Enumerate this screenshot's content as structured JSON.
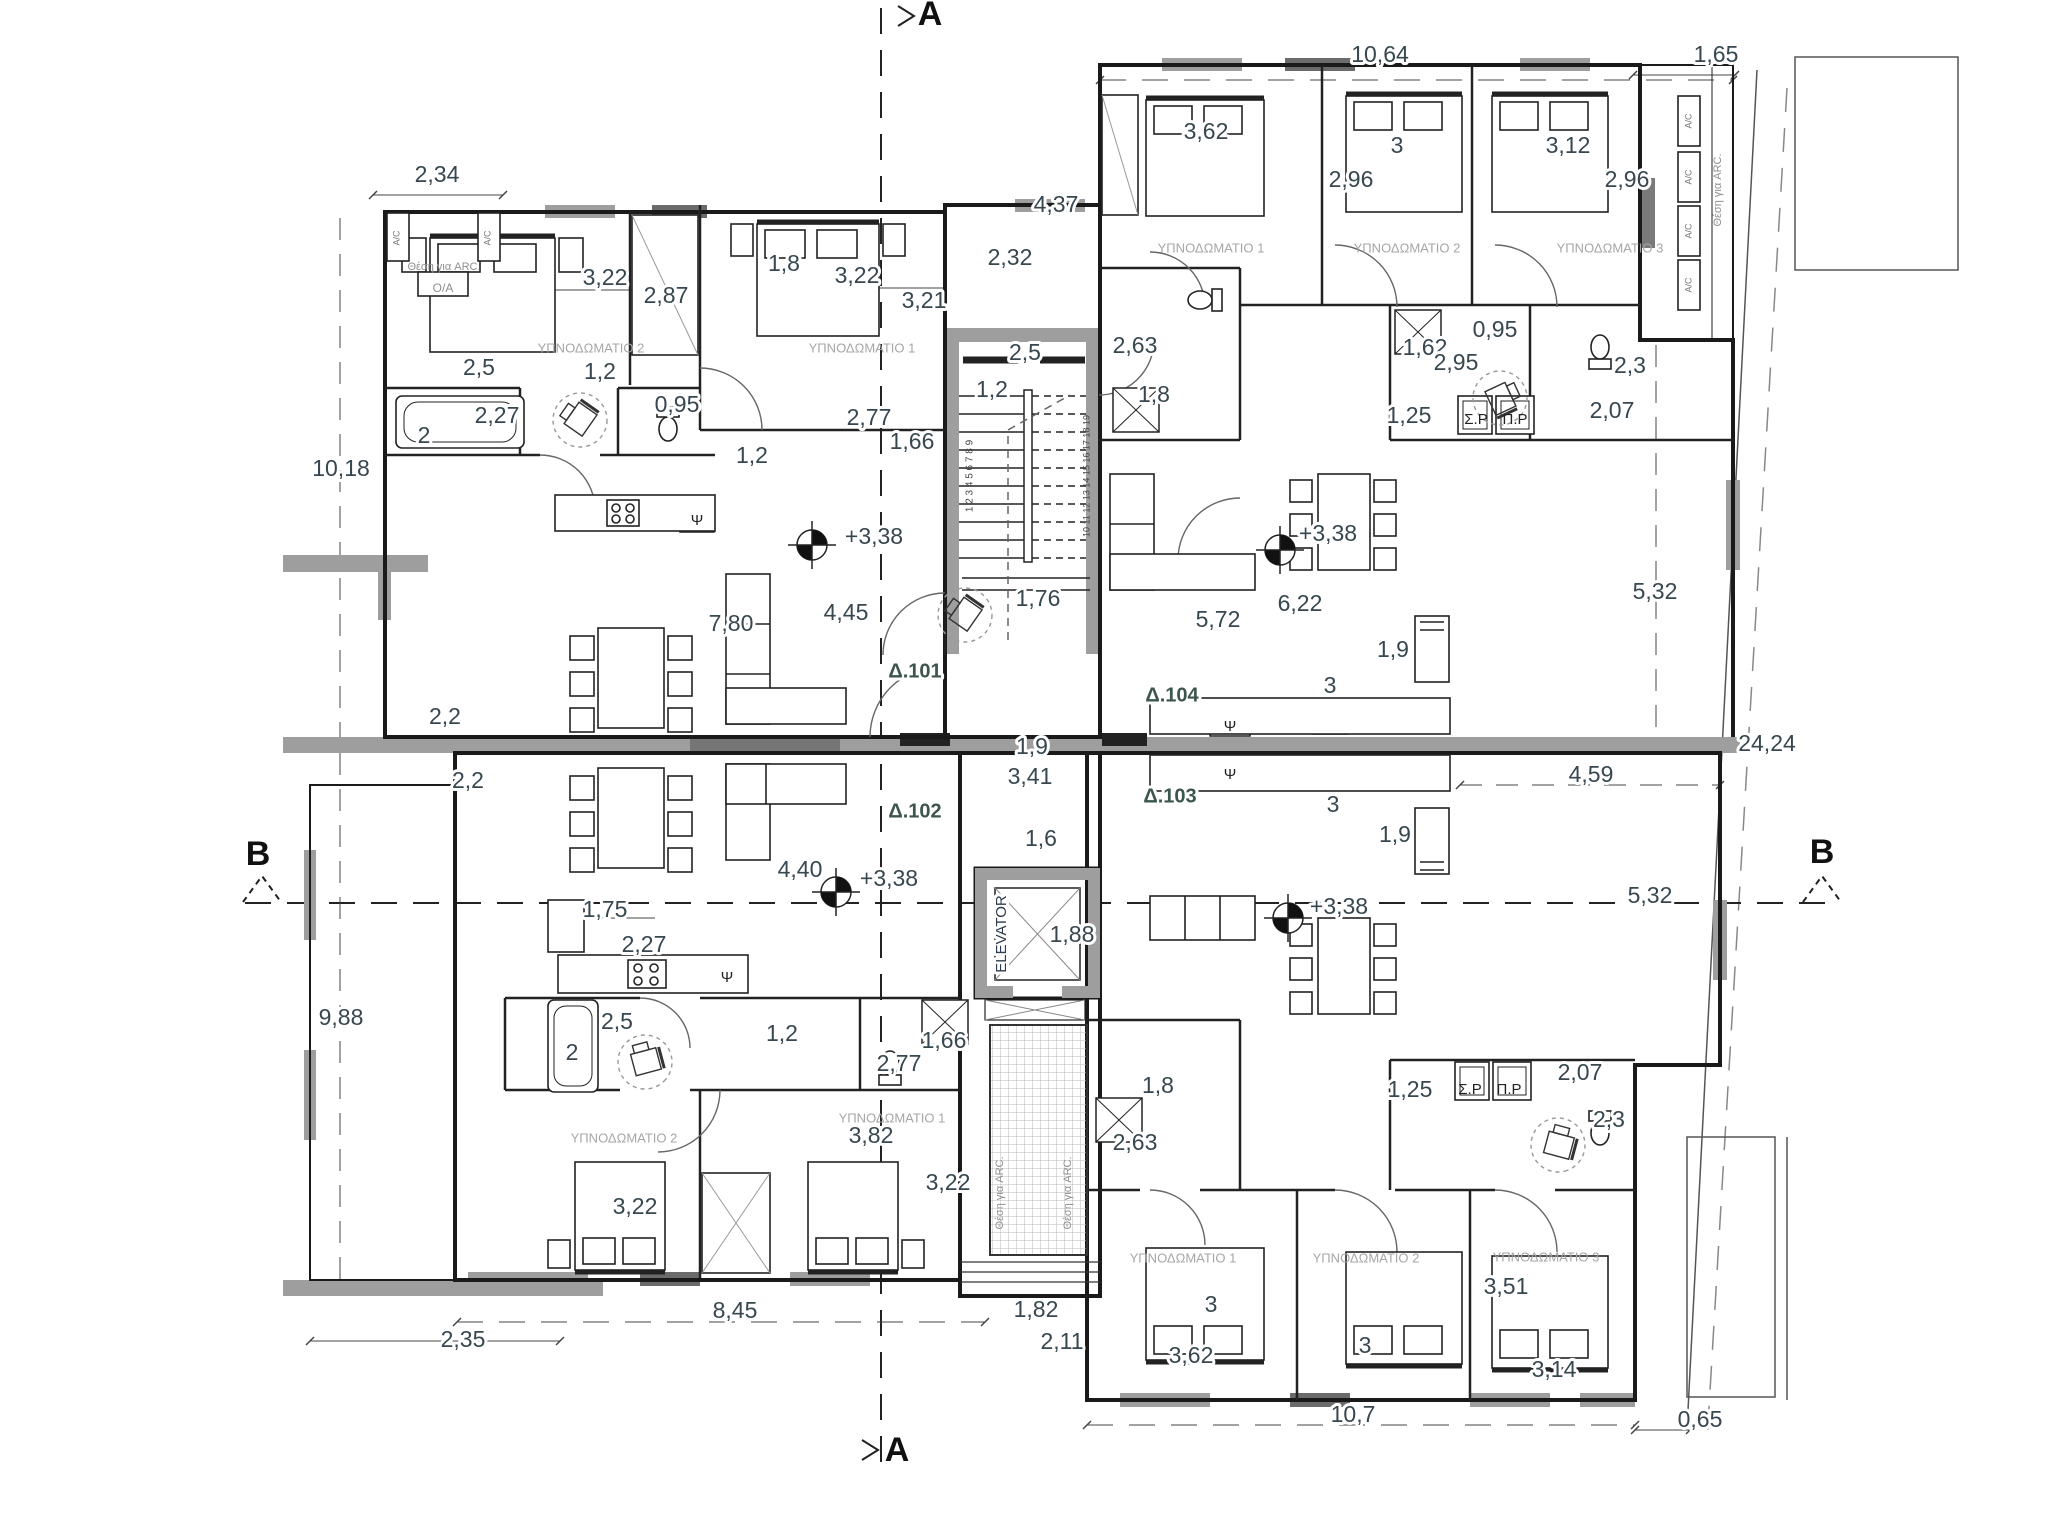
{
  "title": "Floor plan level +3,38 — apartments Δ.101, Δ.102, Δ.103, Δ.104",
  "colors": {
    "dim": "#37474f",
    "room": "#a6a6a6",
    "apt": "#3c554d",
    "sec": "#111111",
    "arc": "#8f8f8f",
    "ac": "#777777",
    "elev": "#2e3b4e",
    "psi": "#222222",
    "num": "#444444",
    "wall": "#1a1a1a",
    "gray_wall": "#9e9e9e"
  },
  "labels": [
    {
      "t": "A",
      "x": 930,
      "y": 16,
      "s": 34,
      "k": "sec",
      "n": "section-marker-a-top"
    },
    {
      "t": "A",
      "x": 897,
      "y": 1452,
      "s": 34,
      "k": "sec",
      "n": "section-marker-a-bottom"
    },
    {
      "t": "B",
      "x": 258,
      "y": 856,
      "s": 34,
      "k": "sec",
      "n": "section-marker-b-left"
    },
    {
      "t": "B",
      "x": 1822,
      "y": 854,
      "s": 34,
      "k": "sec",
      "n": "section-marker-b-right"
    },
    {
      "t": "2,34",
      "x": 437,
      "y": 176
    },
    {
      "t": "10,64",
      "x": 1380,
      "y": 56
    },
    {
      "t": "1,65",
      "x": 1716,
      "y": 56
    },
    {
      "t": "4,37",
      "x": 1056,
      "y": 206
    },
    {
      "t": "2,32",
      "x": 1010,
      "y": 259
    },
    {
      "t": "3,22",
      "x": 605,
      "y": 279
    },
    {
      "t": "2,87",
      "x": 666,
      "y": 297
    },
    {
      "t": "1,8",
      "x": 784,
      "y": 265
    },
    {
      "t": "3,22",
      "x": 857,
      "y": 277
    },
    {
      "t": "3,21",
      "x": 924,
      "y": 302
    },
    {
      "t": "0,95",
      "x": 677,
      "y": 406
    },
    {
      "t": "2,5",
      "x": 479,
      "y": 369
    },
    {
      "t": "2",
      "x": 424,
      "y": 437
    },
    {
      "t": "2,27",
      "x": 497,
      "y": 417
    },
    {
      "t": "1,2",
      "x": 600,
      "y": 373
    },
    {
      "t": "2,77",
      "x": 869,
      "y": 419
    },
    {
      "t": "1,66",
      "x": 912,
      "y": 443
    },
    {
      "t": "1,2",
      "x": 752,
      "y": 457
    },
    {
      "t": "2,5",
      "x": 1025,
      "y": 354
    },
    {
      "t": "1,2",
      "x": 992,
      "y": 391
    },
    {
      "t": "3,62",
      "x": 1206,
      "y": 133
    },
    {
      "t": "3",
      "x": 1397,
      "y": 147
    },
    {
      "t": "2,96",
      "x": 1351,
      "y": 181
    },
    {
      "t": "3,12",
      "x": 1568,
      "y": 147
    },
    {
      "t": "2,96",
      "x": 1627,
      "y": 181
    },
    {
      "t": "2,63",
      "x": 1135,
      "y": 347
    },
    {
      "t": "1,8",
      "x": 1154,
      "y": 396
    },
    {
      "t": "0,95",
      "x": 1495,
      "y": 331
    },
    {
      "t": "1,62",
      "x": 1425,
      "y": 349
    },
    {
      "t": "2,95",
      "x": 1456,
      "y": 364
    },
    {
      "t": "1,25",
      "x": 1409,
      "y": 417
    },
    {
      "t": "Σ.Ρ",
      "x": 1476,
      "y": 420,
      "s": 15,
      "k": "psi",
      "n": "washer-label"
    },
    {
      "t": "Π.Ρ",
      "x": 1515,
      "y": 420,
      "s": 15,
      "k": "psi",
      "n": "dryer-label"
    },
    {
      "t": "2,3",
      "x": 1630,
      "y": 367
    },
    {
      "t": "2,07",
      "x": 1612,
      "y": 412
    },
    {
      "t": "10,18",
      "x": 341,
      "y": 470
    },
    {
      "t": "2,2",
      "x": 445,
      "y": 718
    },
    {
      "t": "2,2",
      "x": 468,
      "y": 782
    },
    {
      "t": "9,88",
      "x": 341,
      "y": 1019
    },
    {
      "t": "7,80",
      "x": 731,
      "y": 625
    },
    {
      "t": "4,45",
      "x": 846,
      "y": 614
    },
    {
      "t": "+3,38",
      "x": 874,
      "y": 538
    },
    {
      "t": "+3,38",
      "x": 1328,
      "y": 535
    },
    {
      "t": "5,72",
      "x": 1218,
      "y": 621
    },
    {
      "t": "6,22",
      "x": 1300,
      "y": 605
    },
    {
      "t": "1,9",
      "x": 1393,
      "y": 651
    },
    {
      "t": "3",
      "x": 1330,
      "y": 687
    },
    {
      "t": "1,76",
      "x": 1038,
      "y": 600
    },
    {
      "t": "Δ.101",
      "x": 915,
      "y": 672,
      "s": 20,
      "k": "apt",
      "n": "apartment-label-101"
    },
    {
      "t": "Δ.104",
      "x": 1172,
      "y": 696,
      "s": 20,
      "k": "apt",
      "n": "apartment-label-104"
    },
    {
      "t": "Δ.102",
      "x": 915,
      "y": 812,
      "s": 20,
      "k": "apt",
      "n": "apartment-label-102"
    },
    {
      "t": "Δ.103",
      "x": 1170,
      "y": 797,
      "s": 20,
      "k": "apt",
      "n": "apartment-label-103"
    },
    {
      "t": "1,9",
      "x": 1032,
      "y": 748
    },
    {
      "t": "3,41",
      "x": 1030,
      "y": 778
    },
    {
      "t": "1,6",
      "x": 1041,
      "y": 840
    },
    {
      "t": "3",
      "x": 1333,
      "y": 806
    },
    {
      "t": "1,9",
      "x": 1395,
      "y": 836
    },
    {
      "t": "4,59",
      "x": 1591,
      "y": 776
    },
    {
      "t": "24,24",
      "x": 1767,
      "y": 745
    },
    {
      "t": "5,32",
      "x": 1655,
      "y": 593
    },
    {
      "t": "5,32",
      "x": 1650,
      "y": 897
    },
    {
      "t": "ELEVATOR",
      "x": 1002,
      "y": 934,
      "s": 15,
      "r": -90,
      "k": "elev",
      "n": "elevator-label"
    },
    {
      "t": "1,88",
      "x": 1072,
      "y": 936
    },
    {
      "t": "+3,38",
      "x": 889,
      "y": 880
    },
    {
      "t": "4,40",
      "x": 800,
      "y": 871
    },
    {
      "t": "+3,38",
      "x": 1339,
      "y": 908
    },
    {
      "t": "1,75",
      "x": 605,
      "y": 911
    },
    {
      "t": "2,27",
      "x": 644,
      "y": 946
    },
    {
      "t": "2,5",
      "x": 617,
      "y": 1023
    },
    {
      "t": "2",
      "x": 572,
      "y": 1054
    },
    {
      "t": "1,2",
      "x": 782,
      "y": 1035
    },
    {
      "t": "2,77",
      "x": 899,
      "y": 1065
    },
    {
      "t": "1,66",
      "x": 944,
      "y": 1042
    },
    {
      "t": "3,82",
      "x": 871,
      "y": 1137
    },
    {
      "t": "3,22",
      "x": 635,
      "y": 1208
    },
    {
      "t": "3,22",
      "x": 948,
      "y": 1184
    },
    {
      "t": "1,8",
      "x": 1158,
      "y": 1087
    },
    {
      "t": "2,63",
      "x": 1135,
      "y": 1144
    },
    {
      "t": "1,25",
      "x": 1410,
      "y": 1091
    },
    {
      "t": "Σ.Ρ",
      "x": 1470,
      "y": 1090,
      "s": 15,
      "k": "psi",
      "n": "washer-label"
    },
    {
      "t": "Π.Ρ",
      "x": 1509,
      "y": 1090,
      "s": 15,
      "k": "psi",
      "n": "dryer-label"
    },
    {
      "t": "2,07",
      "x": 1580,
      "y": 1074
    },
    {
      "t": "2,3",
      "x": 1609,
      "y": 1121
    },
    {
      "t": "3",
      "x": 1211,
      "y": 1306
    },
    {
      "t": "3,62",
      "x": 1191,
      "y": 1357
    },
    {
      "t": "3",
      "x": 1365,
      "y": 1347
    },
    {
      "t": "3,51",
      "x": 1506,
      "y": 1288
    },
    {
      "t": "3,14",
      "x": 1554,
      "y": 1371
    },
    {
      "t": "8,45",
      "x": 735,
      "y": 1312
    },
    {
      "t": "2,35",
      "x": 463,
      "y": 1341
    },
    {
      "t": "1,82",
      "x": 1036,
      "y": 1311
    },
    {
      "t": "2,11",
      "x": 1062,
      "y": 1343
    },
    {
      "t": "10,7",
      "x": 1353,
      "y": 1416
    },
    {
      "t": "0,65",
      "x": 1700,
      "y": 1421
    },
    {
      "t": "ΥΠΝΟΔΩΜΑΤΙΟ 2",
      "x": 591,
      "y": 349,
      "s": 13,
      "k": "room",
      "n": "room-label-bedroom2"
    },
    {
      "t": "ΥΠΝΟΔΩΜΑΤΙΟ 1",
      "x": 862,
      "y": 349,
      "s": 13,
      "k": "room",
      "n": "room-label-bedroom1"
    },
    {
      "t": "ΥΠΝΟΔΩΜΑΤΙΟ 1",
      "x": 1211,
      "y": 249,
      "s": 13,
      "k": "room",
      "n": "room-label-bedroom1"
    },
    {
      "t": "ΥΠΝΟΔΩΜΑΤΙΟ 2",
      "x": 1407,
      "y": 249,
      "s": 13,
      "k": "room",
      "n": "room-label-bedroom2"
    },
    {
      "t": "ΥΠΝΟΔΩΜΑΤΙΟ 3",
      "x": 1610,
      "y": 249,
      "s": 13,
      "k": "room",
      "n": "room-label-bedroom3"
    },
    {
      "t": "ΥΠΝΟΔΩΜΑΤΙΟ 2",
      "x": 624,
      "y": 1139,
      "s": 13,
      "k": "room",
      "n": "room-label-bedroom2"
    },
    {
      "t": "ΥΠΝΟΔΩΜΑΤΙΟ 1",
      "x": 892,
      "y": 1119,
      "s": 13,
      "k": "room",
      "n": "room-label-bedroom1"
    },
    {
      "t": "ΥΠΝΟΔΩΜΑΤΙΟ 1",
      "x": 1183,
      "y": 1259,
      "s": 13,
      "k": "room",
      "n": "room-label-bedroom1"
    },
    {
      "t": "ΥΠΝΟΔΩΜΑΤΙΟ 2",
      "x": 1366,
      "y": 1259,
      "s": 13,
      "k": "room",
      "n": "room-label-bedroom2"
    },
    {
      "t": "ΥΠΝΟΔΩΜΑΤΙΟ 3",
      "x": 1546,
      "y": 1258,
      "s": 13,
      "k": "room",
      "n": "room-label-bedroom3"
    },
    {
      "t": "Θέση για ARC.",
      "x": 444,
      "y": 267,
      "s": 11,
      "k": "arc",
      "n": "arc-area-label"
    },
    {
      "t": "O/A",
      "x": 443,
      "y": 289,
      "s": 12,
      "k": "arc",
      "n": "oa-label"
    },
    {
      "t": "Θέση για ARC.",
      "x": 1718,
      "y": 190,
      "s": 11,
      "r": -90,
      "k": "arc",
      "n": "arc-area-label"
    },
    {
      "t": "Θέση για ARC.",
      "x": 1000,
      "y": 1193,
      "s": 11,
      "r": -90,
      "k": "arc",
      "n": "arc-area-label"
    },
    {
      "t": "Θέση για ARC.",
      "x": 1068,
      "y": 1193,
      "s": 11,
      "r": -90,
      "k": "arc",
      "n": "arc-area-label"
    },
    {
      "t": "A/C",
      "x": 397,
      "y": 238,
      "s": 9,
      "r": -90,
      "k": "ac",
      "n": "ac-unit-label"
    },
    {
      "t": "A/C",
      "x": 488,
      "y": 238,
      "s": 9,
      "r": -90,
      "k": "ac",
      "n": "ac-unit-label"
    },
    {
      "t": "A/C",
      "x": 1689,
      "y": 121,
      "s": 9,
      "r": -90,
      "k": "ac",
      "n": "ac-unit-label"
    },
    {
      "t": "A/C",
      "x": 1689,
      "y": 177,
      "s": 9,
      "r": -90,
      "k": "ac",
      "n": "ac-unit-label"
    },
    {
      "t": "A/C",
      "x": 1689,
      "y": 231,
      "s": 9,
      "r": -90,
      "k": "ac",
      "n": "ac-unit-label"
    },
    {
      "t": "A/C",
      "x": 1689,
      "y": 285,
      "s": 9,
      "r": -90,
      "k": "ac",
      "n": "ac-unit-label"
    },
    {
      "t": "Ψ",
      "x": 697,
      "y": 521,
      "s": 15,
      "k": "psi",
      "n": "sink-symbol"
    },
    {
      "t": "Ψ",
      "x": 727,
      "y": 978,
      "s": 15,
      "k": "psi",
      "n": "sink-symbol"
    },
    {
      "t": "Ψ",
      "x": 1230,
      "y": 727,
      "s": 15,
      "k": "psi",
      "n": "sink-symbol"
    },
    {
      "t": "Ψ",
      "x": 1230,
      "y": 775,
      "s": 15,
      "k": "psi",
      "n": "sink-symbol"
    },
    {
      "t": "1 2 3 4 5 6 7 8 9",
      "x": 970,
      "y": 476,
      "s": 10,
      "r": -90,
      "k": "num",
      "n": "stair-step-numbers"
    },
    {
      "t": "10 11 12 13 14 15 16 17 18 19",
      "x": 1087,
      "y": 476,
      "s": 9,
      "r": -90,
      "k": "num",
      "n": "stair-step-numbers"
    }
  ]
}
